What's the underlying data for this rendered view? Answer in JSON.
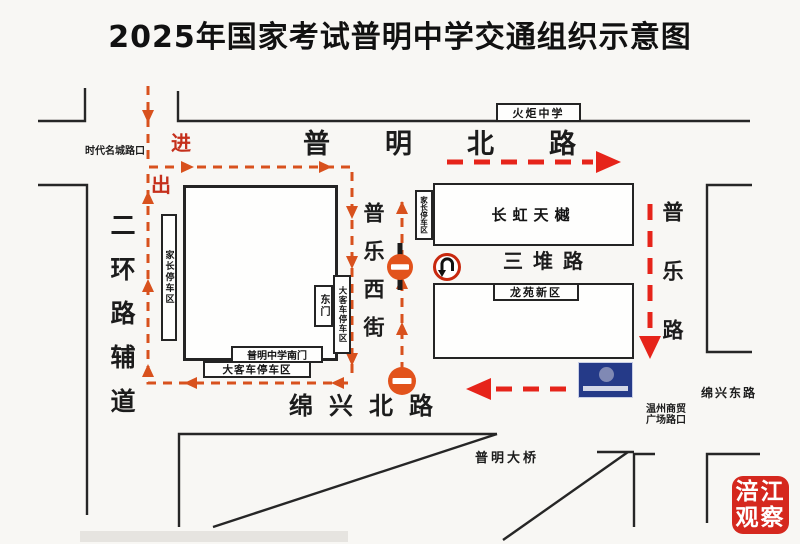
{
  "title": "2025年国家考试普明中学交通组织示意图",
  "roads": {
    "puming_north_road": "普明北路",
    "mianxing_north_road": "绵兴北路",
    "mianxing_east_road": "绵兴东路",
    "second_ring_side_road": "二环路辅道",
    "pule_west_street": "普乐西街",
    "pule_road": "普乐路",
    "sandui_road": "三堆路",
    "puming_bridge": "普明大桥"
  },
  "places": {
    "torch_middle_school": "火炬中学",
    "changhong_tianyue": "长虹天樾",
    "longyuan_new_district": "龙苑新区",
    "shidai_mingcheng_intersection": "时代名城路口",
    "wenzhou_plaza_line1": "温州商贸",
    "wenzhou_plaza_line2": "广场路口",
    "school_south_gate": "普明中学南门",
    "school_east_gate": "东门"
  },
  "parking_zones": {
    "parents_parking_west": "家长停车区",
    "parents_parking_east": "家长停车区",
    "bus_parking_side": "大客车停车区",
    "bus_parking_south": "大客车停车区"
  },
  "flow_labels": {
    "enter": "进",
    "exit": "出"
  },
  "watermark": {
    "line1": "涪江",
    "line2": "观察"
  },
  "icons": {
    "no_entry_sign": "no-entry",
    "no_u_turn_sign": "no-u-turn",
    "blue_parking_sign": "blue-notice"
  },
  "colors": {
    "loop_orange": "#d8511d",
    "flow_red": "#e6241a",
    "sign_orange": "#e2531c",
    "sign_blue": "#253a88",
    "logo_red": "#d5281e"
  }
}
